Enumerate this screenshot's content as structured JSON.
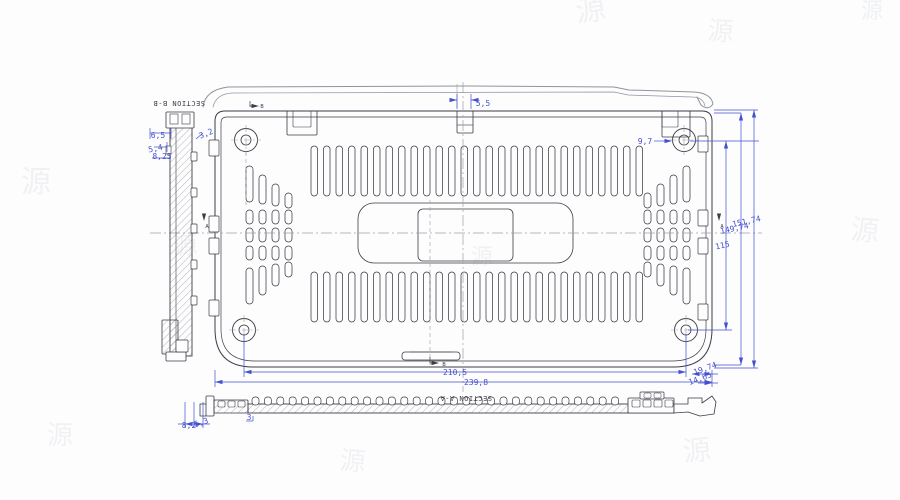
{
  "colors": {
    "line": "#3c3c46",
    "thin": "#6a6a74",
    "profile": "#8f939b",
    "dim": "#4450d0",
    "center": "#9aa0a6",
    "hatch": "#7a7a84",
    "label": "#3d3d44",
    "watermark": "#8a929e"
  },
  "drawing": {
    "section_labels": [
      {
        "text": "SECTION B-B",
        "x": 179,
        "y": 101,
        "rotate": 180
      },
      {
        "text": "SECTION A-A",
        "x": 466,
        "y": 396,
        "rotate": 180
      }
    ],
    "dimensions": [
      {
        "t": "5,5",
        "x": 483,
        "y": 106,
        "r": 0
      },
      {
        "t": "9,7",
        "x": 645,
        "y": 144,
        "r": 0
      },
      {
        "t": "3,2",
        "x": 207,
        "y": 136,
        "r": -22
      },
      {
        "t": "6,5",
        "x": 158,
        "y": 138,
        "r": 0
      },
      {
        "t": "5,4",
        "x": 156,
        "y": 151,
        "r": -12
      },
      {
        "t": "8,25",
        "x": 162,
        "y": 159,
        "r": 0
      },
      {
        "t": "151,74",
        "x": 747,
        "y": 224,
        "r": -12
      },
      {
        "t": "149,74",
        "x": 735,
        "y": 231,
        "r": -12
      },
      {
        "t": "115",
        "x": 723,
        "y": 248,
        "r": -12
      },
      {
        "t": "210,5",
        "x": 455,
        "y": 375,
        "r": 0
      },
      {
        "t": "239,8",
        "x": 476,
        "y": 385,
        "r": 0
      },
      {
        "t": "19,74",
        "x": 706,
        "y": 371,
        "r": -20
      },
      {
        "t": "14,65",
        "x": 701,
        "y": 381,
        "r": -20
      },
      {
        "t": "8,2",
        "x": 189,
        "y": 428,
        "r": 0
      },
      {
        "t": "5,3",
        "x": 202,
        "y": 425,
        "r": -18
      },
      {
        "t": "3",
        "x": 249,
        "y": 420,
        "r": 0
      }
    ],
    "markers": [
      {
        "text": "B",
        "x": 262,
        "y": 108
      },
      {
        "text": "B",
        "x": 444,
        "y": 366
      },
      {
        "text": "A",
        "x": 207,
        "y": 228
      },
      {
        "text": "A",
        "x": 722,
        "y": 228
      }
    ]
  },
  "watermark": {
    "glyph": "源",
    "spots": [
      [
        592,
        20,
        30,
        -8
      ],
      [
        720,
        40,
        26,
        4
      ],
      [
        36,
        192,
        30,
        0
      ],
      [
        864,
        240,
        28,
        6
      ],
      [
        186,
        254,
        24,
        -4
      ],
      [
        60,
        444,
        26,
        0
      ],
      [
        352,
        470,
        26,
        5
      ],
      [
        698,
        460,
        28,
        -6
      ],
      [
        482,
        264,
        22,
        0
      ],
      [
        872,
        18,
        22,
        0
      ]
    ]
  }
}
